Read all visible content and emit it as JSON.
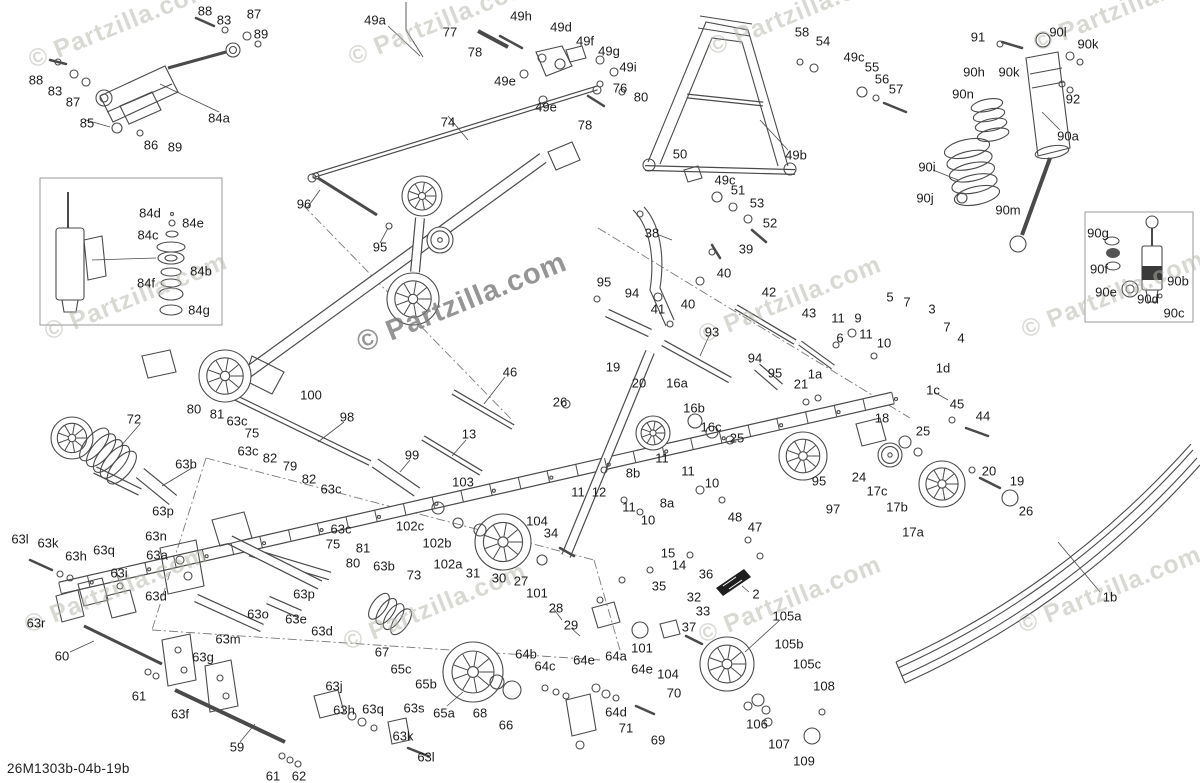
{
  "meta": {
    "diagram_code": "26M1303b-04b-19b",
    "watermark_text": "© Partzilla.com",
    "colors": {
      "line": "#4a4a4a",
      "label": "#1c1c1c",
      "watermark": "#b5b5ab",
      "watermark_center": "#787878",
      "background": "#ffffff"
    }
  },
  "watermarks": [
    {
      "x": 120,
      "y": 25,
      "s": 25,
      "big": false
    },
    {
      "x": 440,
      "y": 22,
      "s": 25,
      "big": false
    },
    {
      "x": 800,
      "y": 12,
      "s": 25,
      "big": false
    },
    {
      "x": 1125,
      "y": 8,
      "s": 25,
      "big": false
    },
    {
      "x": 136,
      "y": 297,
      "s": 25,
      "big": false
    },
    {
      "x": 462,
      "y": 303,
      "s": 29,
      "big": true
    },
    {
      "x": 790,
      "y": 300,
      "s": 25,
      "big": false
    },
    {
      "x": 1113,
      "y": 295,
      "s": 25,
      "big": false
    },
    {
      "x": 116,
      "y": 590,
      "s": 25,
      "big": false
    },
    {
      "x": 435,
      "y": 607,
      "s": 25,
      "big": false
    },
    {
      "x": 790,
      "y": 600,
      "s": 25,
      "big": false
    },
    {
      "x": 1110,
      "y": 590,
      "s": 25,
      "big": false
    }
  ],
  "labels": [
    [
      "88",
      205,
      11
    ],
    [
      "83",
      224,
      20
    ],
    [
      "87",
      254,
      14
    ],
    [
      "89",
      261,
      34
    ],
    [
      "88",
      36,
      80
    ],
    [
      "83",
      55,
      91
    ],
    [
      "87",
      73,
      102
    ],
    [
      "85",
      87,
      123
    ],
    [
      "86",
      151,
      145
    ],
    [
      "89",
      175,
      147
    ],
    [
      "84a",
      219,
      118
    ],
    [
      "84d",
      150,
      213
    ],
    [
      "84e",
      193,
      223
    ],
    [
      "84c",
      148,
      235
    ],
    [
      "84b",
      201,
      271
    ],
    [
      "84f",
      146,
      283
    ],
    [
      "84g",
      199,
      310
    ],
    [
      "49a",
      375,
      20
    ],
    [
      "77",
      450,
      32
    ],
    [
      "78",
      475,
      52
    ],
    [
      "49h",
      521,
      16
    ],
    [
      "49d",
      561,
      27
    ],
    [
      "49f",
      585,
      41
    ],
    [
      "49e",
      505,
      81
    ],
    [
      "49e",
      546,
      107
    ],
    [
      "74",
      448,
      122
    ],
    [
      "78",
      585,
      125
    ],
    [
      "49g",
      609,
      51
    ],
    [
      "49i",
      628,
      67
    ],
    [
      "76",
      620,
      88
    ],
    [
      "80",
      641,
      97
    ],
    [
      "58",
      802,
      32
    ],
    [
      "54",
      823,
      41
    ],
    [
      "49c",
      854,
      57
    ],
    [
      "55",
      872,
      67
    ],
    [
      "56",
      882,
      79
    ],
    [
      "57",
      896,
      89
    ],
    [
      "50",
      680,
      154
    ],
    [
      "49b",
      796,
      155
    ],
    [
      "49c",
      725,
      180
    ],
    [
      "51",
      738,
      190
    ],
    [
      "53",
      757,
      203
    ],
    [
      "52",
      770,
      223
    ],
    [
      "91",
      978,
      37
    ],
    [
      "90l",
      1058,
      32
    ],
    [
      "90k",
      1088,
      44
    ],
    [
      "90k",
      1009,
      72
    ],
    [
      "90h",
      974,
      72
    ],
    [
      "90n",
      963,
      94
    ],
    [
      "92",
      1073,
      99
    ],
    [
      "90a",
      1068,
      136
    ],
    [
      "90i",
      927,
      167
    ],
    [
      "90j",
      925,
      198
    ],
    [
      "90m",
      1008,
      210
    ],
    [
      "90g",
      1098,
      233
    ],
    [
      "90f",
      1099,
      269
    ],
    [
      "90e",
      1106,
      292
    ],
    [
      "90d",
      1148,
      299
    ],
    [
      "90b",
      1178,
      281
    ],
    [
      "90c",
      1174,
      313
    ],
    [
      "5",
      890,
      297
    ],
    [
      "7",
      907,
      302
    ],
    [
      "3",
      932,
      309
    ],
    [
      "7",
      947,
      327
    ],
    [
      "4",
      961,
      338
    ],
    [
      "1d",
      943,
      368
    ],
    [
      "1c",
      933,
      390
    ],
    [
      "96",
      304,
      204
    ],
    [
      "95",
      380,
      247
    ],
    [
      "38",
      652,
      233
    ],
    [
      "39",
      746,
      249
    ],
    [
      "40",
      724,
      273
    ],
    [
      "40",
      688,
      304
    ],
    [
      "41",
      658,
      309
    ],
    [
      "95",
      604,
      282
    ],
    [
      "94",
      632,
      293
    ],
    [
      "42",
      769,
      292
    ],
    [
      "93",
      712,
      332
    ],
    [
      "43",
      809,
      313
    ],
    [
      "11",
      838,
      318
    ],
    [
      "9",
      858,
      318
    ],
    [
      "6",
      840,
      338
    ],
    [
      "11",
      866,
      334
    ],
    [
      "10",
      884,
      343
    ],
    [
      "94",
      755,
      358
    ],
    [
      "95",
      775,
      373
    ],
    [
      "1a",
      815,
      374
    ],
    [
      "21",
      801,
      384
    ],
    [
      "100",
      311,
      395
    ],
    [
      "46",
      510,
      372
    ],
    [
      "26",
      560,
      402
    ],
    [
      "19",
      613,
      367
    ],
    [
      "20",
      639,
      383
    ],
    [
      "16a",
      677,
      383
    ],
    [
      "16b",
      694,
      408
    ],
    [
      "16c",
      711,
      427
    ],
    [
      "25",
      737,
      438
    ],
    [
      "18",
      882,
      418
    ],
    [
      "98",
      347,
      417
    ],
    [
      "13",
      469,
      434
    ],
    [
      "99",
      412,
      455
    ],
    [
      "103",
      463,
      482
    ],
    [
      "102c",
      410,
      526
    ],
    [
      "102b",
      437,
      543
    ],
    [
      "102a",
      448,
      564
    ],
    [
      "104",
      537,
      521
    ],
    [
      "34",
      551,
      533
    ],
    [
      "11",
      578,
      492
    ],
    [
      "12",
      599,
      492
    ],
    [
      "8b",
      633,
      473
    ],
    [
      "11",
      662,
      458
    ],
    [
      "11",
      688,
      471
    ],
    [
      "10",
      712,
      483
    ],
    [
      "8a",
      667,
      503
    ],
    [
      "11",
      629,
      507
    ],
    [
      "10",
      648,
      520
    ],
    [
      "95",
      819,
      481
    ],
    [
      "97",
      833,
      509
    ],
    [
      "24",
      859,
      477
    ],
    [
      "17c",
      877,
      491
    ],
    [
      "17b",
      897,
      507
    ],
    [
      "45",
      957,
      404
    ],
    [
      "44",
      983,
      416
    ],
    [
      "25",
      923,
      431
    ],
    [
      "20",
      989,
      471
    ],
    [
      "19",
      1017,
      481
    ],
    [
      "26",
      1026,
      511
    ],
    [
      "17a",
      913,
      532
    ],
    [
      "48",
      735,
      517
    ],
    [
      "47",
      755,
      527
    ],
    [
      "15",
      668,
      553
    ],
    [
      "14",
      679,
      565
    ],
    [
      "36",
      706,
      574
    ],
    [
      "35",
      659,
      586
    ],
    [
      "32",
      694,
      597
    ],
    [
      "33",
      703,
      611
    ],
    [
      "37",
      689,
      627
    ],
    [
      "2",
      756,
      594
    ],
    [
      "31",
      473,
      573
    ],
    [
      "30",
      499,
      578
    ],
    [
      "27",
      521,
      581
    ],
    [
      "101",
      537,
      593
    ],
    [
      "73",
      414,
      575
    ],
    [
      "72",
      134,
      419
    ],
    [
      "80",
      194,
      409
    ],
    [
      "81",
      217,
      414
    ],
    [
      "63c",
      237,
      421
    ],
    [
      "75",
      252,
      433
    ],
    [
      "63c",
      248,
      451
    ],
    [
      "82",
      270,
      458
    ],
    [
      "79",
      290,
      466
    ],
    [
      "63b",
      186,
      464
    ],
    [
      "82",
      309,
      479
    ],
    [
      "63c",
      331,
      489
    ],
    [
      "63c",
      341,
      529
    ],
    [
      "75",
      333,
      544
    ],
    [
      "81",
      363,
      548
    ],
    [
      "80",
      353,
      563
    ],
    [
      "63b",
      384,
      566
    ],
    [
      "63p",
      163,
      511
    ],
    [
      "63n",
      156,
      536
    ],
    [
      "63a",
      157,
      555
    ],
    [
      "63l",
      20,
      539
    ],
    [
      "63k",
      48,
      543
    ],
    [
      "63h",
      76,
      556
    ],
    [
      "63q",
      104,
      550
    ],
    [
      "63i",
      119,
      573
    ],
    [
      "63r",
      36,
      623
    ],
    [
      "60",
      62,
      656
    ],
    [
      "63d",
      156,
      596
    ],
    [
      "63p",
      304,
      594
    ],
    [
      "63o",
      258,
      614
    ],
    [
      "63e",
      296,
      619
    ],
    [
      "63d",
      322,
      631
    ],
    [
      "63m",
      228,
      639
    ],
    [
      "63g",
      203,
      657
    ],
    [
      "61",
      139,
      696
    ],
    [
      "63f",
      180,
      714
    ],
    [
      "59",
      237,
      747
    ],
    [
      "61",
      273,
      776
    ],
    [
      "62",
      299,
      776
    ],
    [
      "63j",
      334,
      686
    ],
    [
      "63h",
      344,
      710
    ],
    [
      "63q",
      373,
      709
    ],
    [
      "63s",
      414,
      708
    ],
    [
      "63k",
      403,
      736
    ],
    [
      "63l",
      426,
      757
    ],
    [
      "67",
      382,
      652
    ],
    [
      "65c",
      401,
      669
    ],
    [
      "65b",
      426,
      684
    ],
    [
      "65a",
      444,
      713
    ],
    [
      "68",
      480,
      713
    ],
    [
      "66",
      506,
      725
    ],
    [
      "64b",
      526,
      654
    ],
    [
      "64c",
      545,
      666
    ],
    [
      "64e",
      584,
      660
    ],
    [
      "28",
      556,
      608
    ],
    [
      "29",
      571,
      625
    ],
    [
      "101",
      642,
      648
    ],
    [
      "104",
      668,
      674
    ],
    [
      "64a",
      616,
      656
    ],
    [
      "64e",
      642,
      669
    ],
    [
      "70",
      674,
      693
    ],
    [
      "64d",
      616,
      712
    ],
    [
      "71",
      626,
      728
    ],
    [
      "69",
      658,
      740
    ],
    [
      "105a",
      787,
      616
    ],
    [
      "105b",
      789,
      644
    ],
    [
      "105c",
      807,
      664
    ],
    [
      "106",
      757,
      724
    ],
    [
      "107",
      779,
      744
    ],
    [
      "108",
      824,
      686
    ],
    [
      "109",
      804,
      761
    ],
    [
      "1b",
      1110,
      597
    ]
  ]
}
